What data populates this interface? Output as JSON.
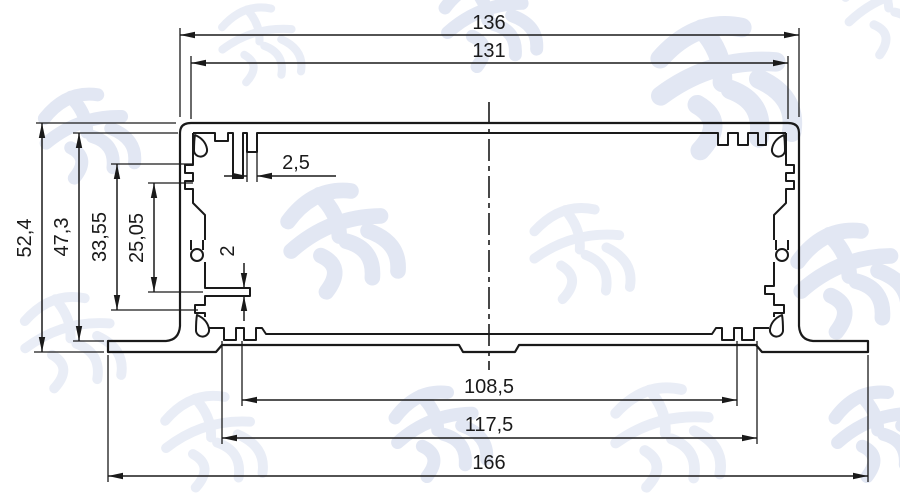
{
  "drawing": {
    "kind": "aluminum-extrusion-enclosure-cross-section",
    "watermark": "鸿发顺达",
    "style": {
      "line_color": "#1a1a1a",
      "watermark_color": "#e2e7f3",
      "background": "#ffffff"
    },
    "dims": {
      "top_width_outer": "136",
      "top_width_inner": "131",
      "height_overall": "52,4",
      "height_inner": "47,3",
      "height_slot_outer": "33,55",
      "height_slot_inner": "25,05",
      "top_rib_thickness": "2,5",
      "side_rib_thickness": "2",
      "bottom_width_inner": "108,5",
      "bottom_width_groove": "117,5",
      "bottom_width_overall": "166"
    }
  }
}
